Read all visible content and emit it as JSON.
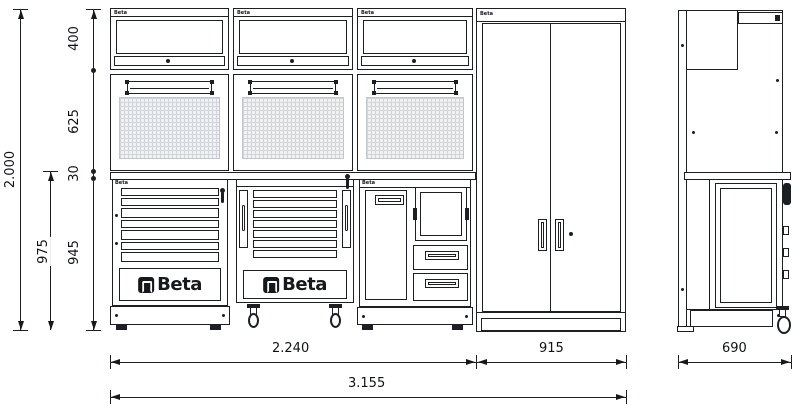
{
  "brand": {
    "logo_text": "Beta",
    "mini_label": "Beta"
  },
  "dimensions": {
    "total_height": "2.000",
    "upper_cabinet_height": "400",
    "panel_height": "625",
    "worktop_thickness": "30",
    "base_unit_height": "945",
    "base_total_height": "975",
    "bench_width": "2.240",
    "tall_cabinet_width": "915",
    "total_width": "3.155",
    "depth": "690"
  }
}
